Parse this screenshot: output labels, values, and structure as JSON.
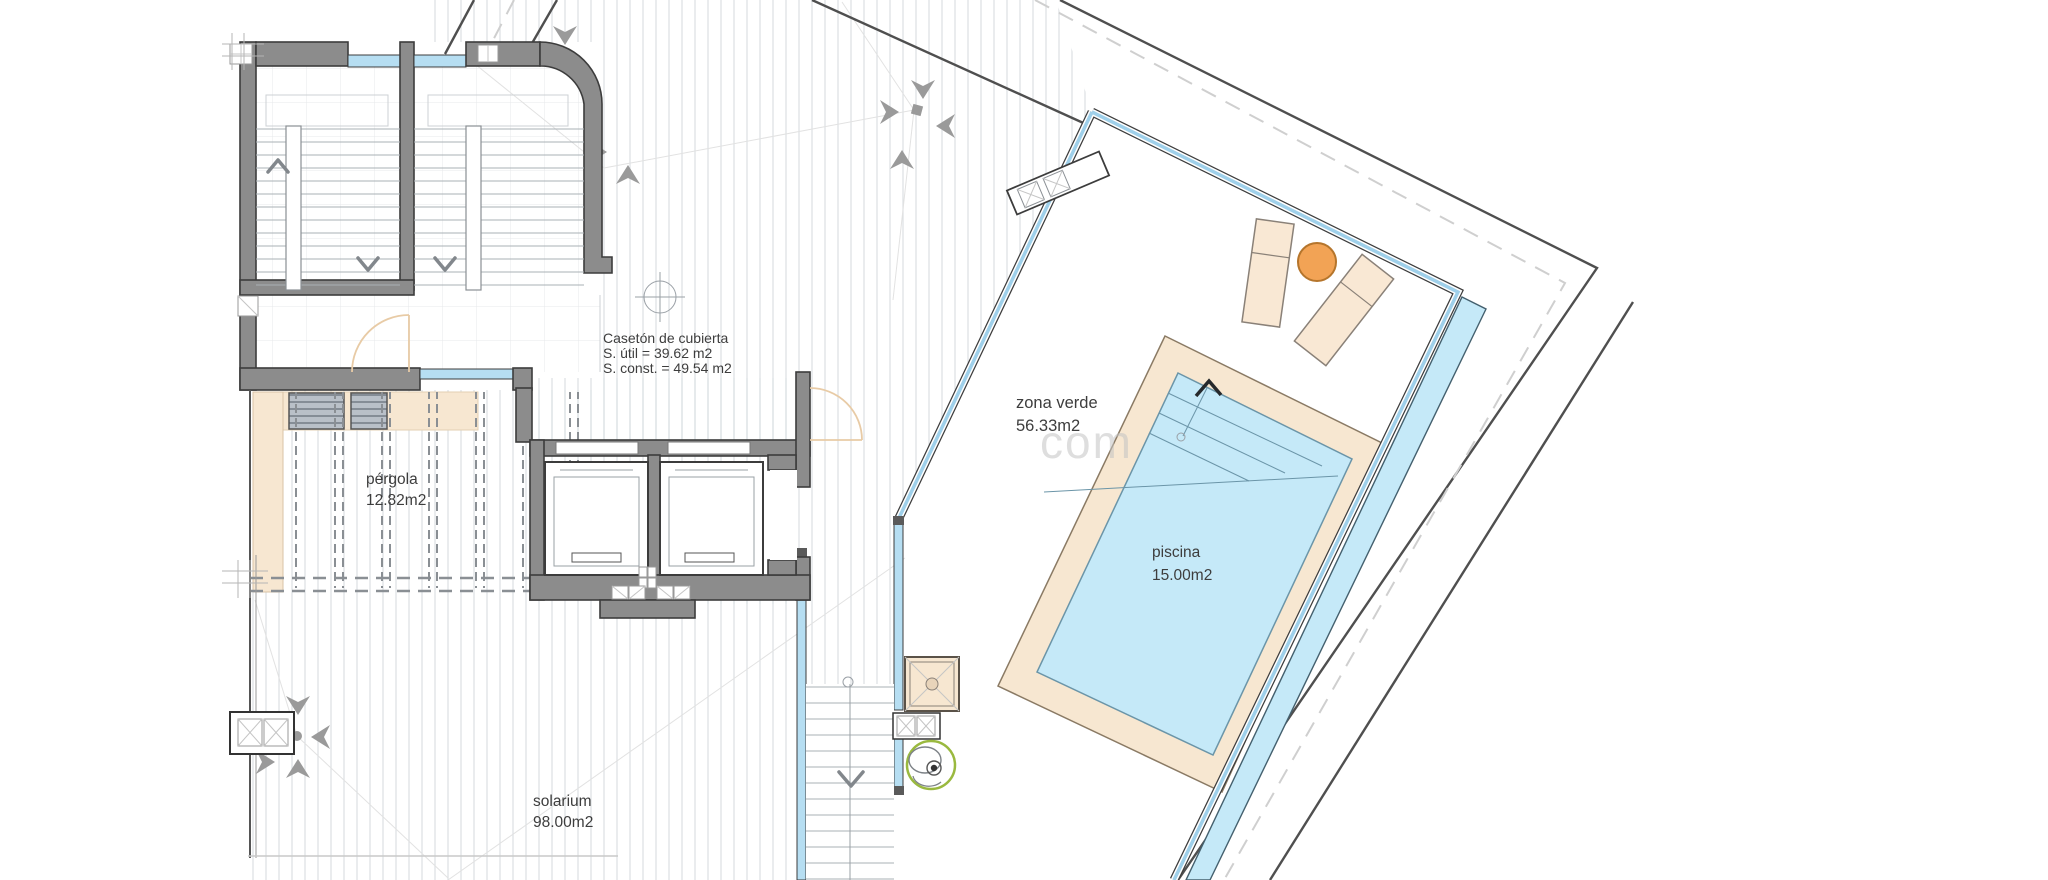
{
  "plan": {
    "labels": {
      "caseton_line1": "Casetón de cubierta",
      "caseton_line2": "S. útil = 39.62 m2",
      "caseton_line3": "S. const. = 49.54 m2",
      "pergola_line1": "pérgola",
      "pergola_line2": "12.82m2",
      "solarium_line1": "solarium",
      "solarium_line2": "98.00m2",
      "zona_verde_line1": "zona verde",
      "zona_verde_line2": "56.33m2",
      "piscina_line1": "piscina",
      "piscina_line2": "15.00m2"
    },
    "watermark": "com",
    "colors": {
      "wall": "#8c8c8c",
      "wall_outline": "#3c3c3c",
      "glazing": "#b6def2",
      "water": "#c5e9f8",
      "paving": "#f7e7d1",
      "paving_edge": "#8a7a64",
      "lounger": "#f9e8d4",
      "lounger_edge": "#8a8178",
      "table": "#f2a355",
      "table_edge": "#b5752c",
      "plant_green": "#9ab93f",
      "deck_line": "#dbdfe2",
      "boundary": "#4f4f4f",
      "arrow": "#9a9a9a",
      "text": "#3d3d3d"
    }
  }
}
